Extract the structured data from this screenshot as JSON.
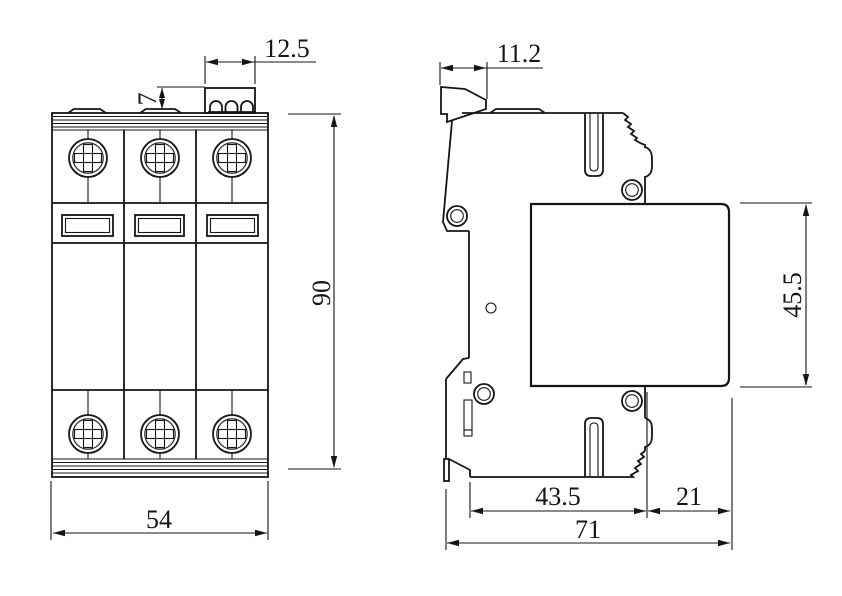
{
  "drawing": {
    "type": "technical-dimension-drawing",
    "subject": "3-pole DIN-rail mounted surge protective device, front and side orthographic views",
    "colors": {
      "background": "#ffffff",
      "line": "#151515"
    }
  },
  "views": {
    "front": {
      "dimensions": {
        "terminal_width": "12.5",
        "terminal_height": "7",
        "body_height": "90",
        "body_width": "54"
      }
    },
    "side": {
      "dimensions": {
        "clip_offset": "11.2",
        "module_height": "45.5",
        "base_depth": "43.5",
        "module_overhang": "21",
        "overall_depth": "71"
      }
    }
  }
}
